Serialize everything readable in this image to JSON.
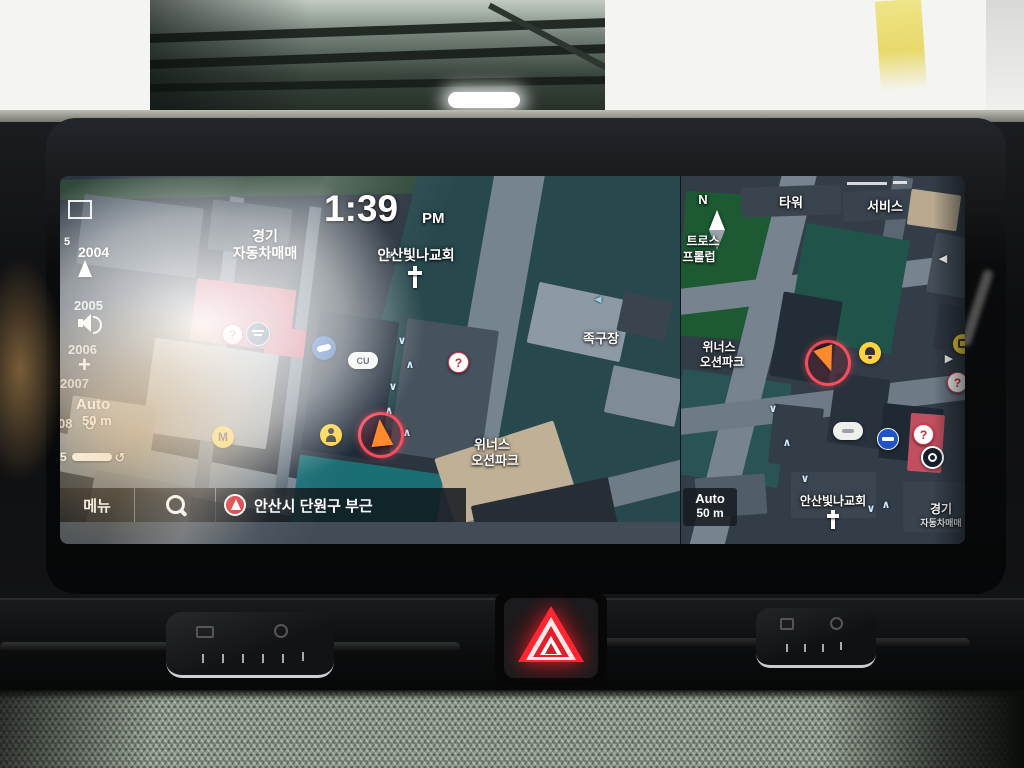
{
  "display": {
    "left_map": {
      "time": "1:39",
      "meridiem": "PM",
      "labels": {
        "car_market_line1": "경기",
        "car_market_line2": "자동차매매",
        "church": "안산빛나교회",
        "sports_court": "족구장",
        "park_line1": "위너스",
        "park_line2": "오션파크",
        "cu_store": "CU"
      },
      "side_panel": {
        "num_prefix": "5",
        "num_1": "2004",
        "num_2": "2005",
        "num_3": "2006",
        "num_4": "2007",
        "num_partial": "08",
        "num_bottom": "5",
        "scale_mode": "Auto",
        "scale_value": "50 m",
        "zoom_in": "+"
      },
      "bottom_bar": {
        "menu": "메뉴",
        "current_area": "안산시 단원구 부근"
      }
    },
    "right_map": {
      "compass": "N",
      "labels": {
        "tower": "타워",
        "service": "서비스",
        "cut_line1": "트로스",
        "cut_line2": "프롤럽",
        "park_line1": "위너스",
        "park_line2": "오션파크",
        "church": "안산빛나교회",
        "car_market_line1": "경기",
        "car_market_line2": "자동차매매"
      },
      "scale_mode": "Auto",
      "scale_value": "50 m"
    },
    "glyphs": {
      "up": "∧",
      "down": "∨",
      "left": "<",
      "right": ">",
      "play": "▶",
      "back": "◀",
      "uturn": "↺",
      "question": "?",
      "m_badge": "M"
    },
    "colors": {
      "marker_ring": "#ff4757",
      "marker_arrow": "#ff8a2e",
      "water_teal": "#27484d",
      "park_green": "#1d5a33",
      "building_red": "#c45568",
      "road_gray": "#76848f",
      "poi_yellow": "#ffd43a",
      "no_entry_blue": "#1f54c9",
      "hazard_red": "#ff2531"
    },
    "icons": {
      "search": "magnifier",
      "location_arrow": "nav-arrow-in-red-circle",
      "church_cross": "cross",
      "compass_needle": "diamond-needle",
      "mute_speaker": "speaker",
      "no_entry": "circle-with-bar",
      "bell": "bell-in-yellow-circle",
      "person": "person-in-yellow-circle",
      "hazard": "warning-triangle"
    }
  }
}
